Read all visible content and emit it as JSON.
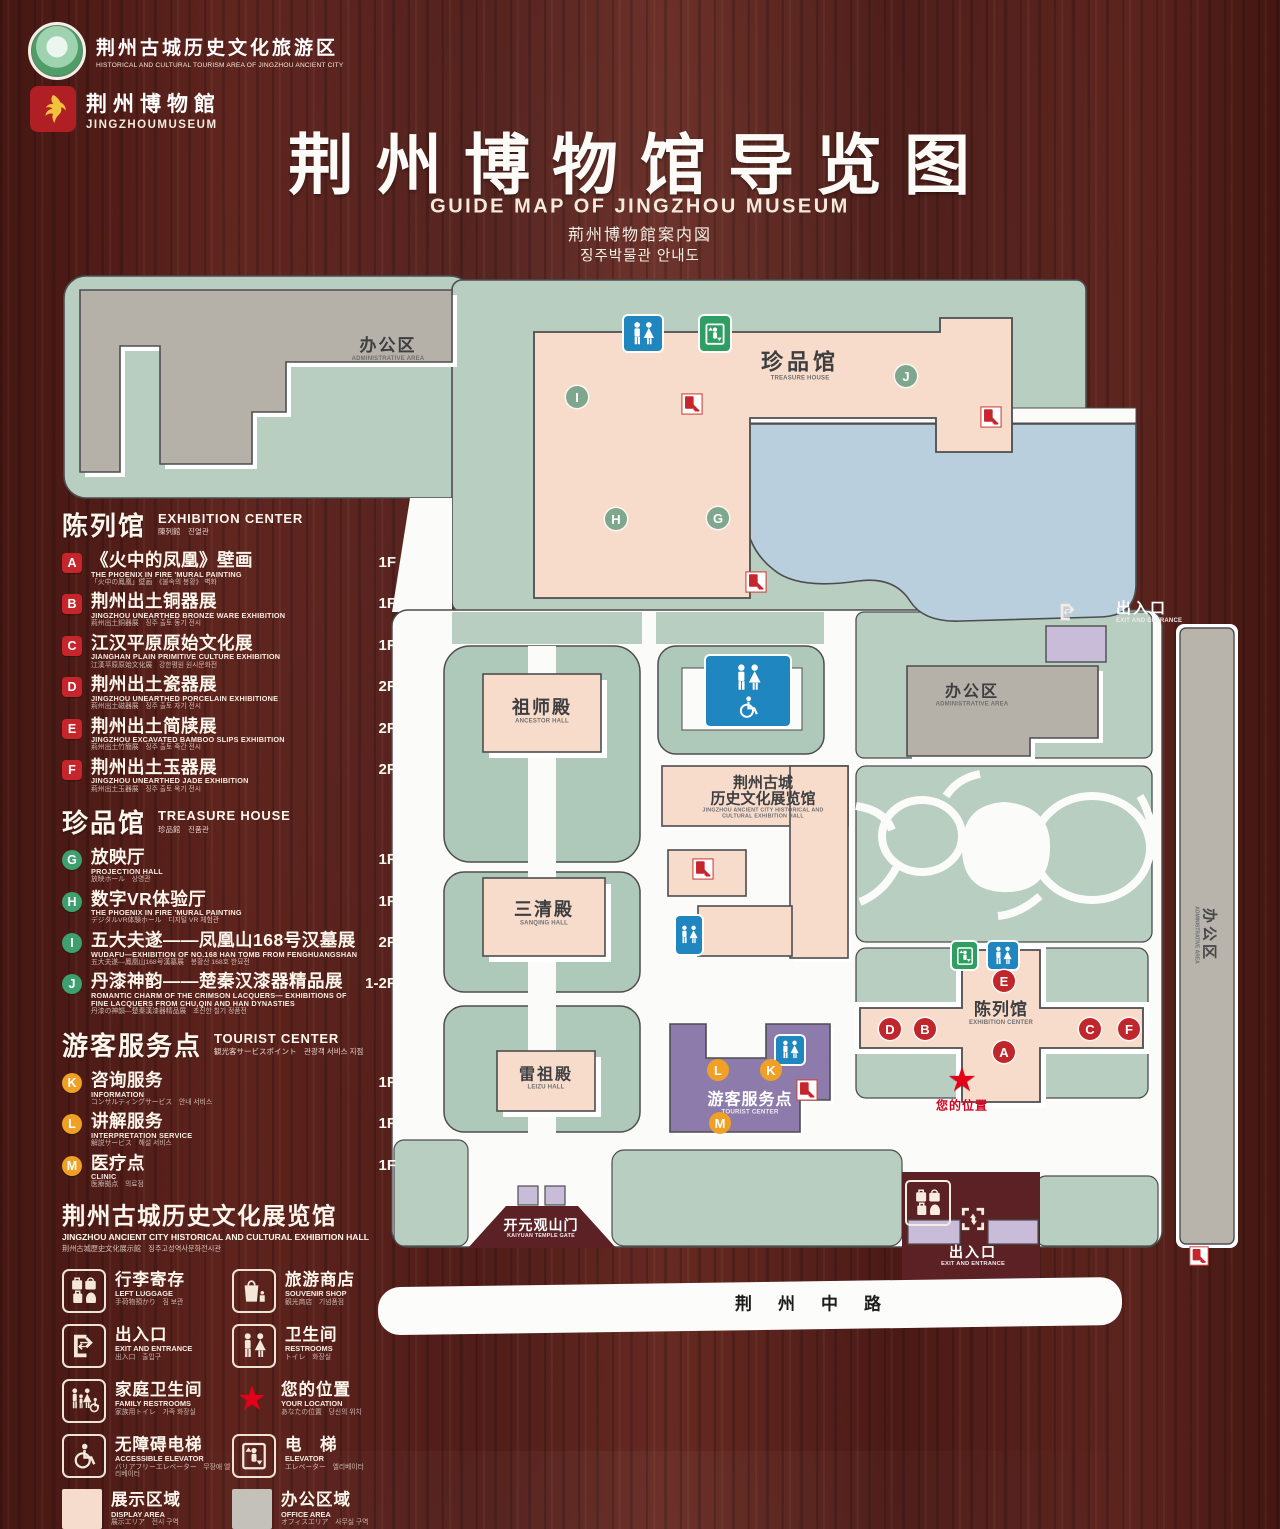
{
  "colors": {
    "wood": "#511d19",
    "map_green": "#b7cec1",
    "building_pink": "#f7dccc",
    "lake_blue": "#b9cfdd",
    "office_gray": "#b6b1a8",
    "tourist_purple": "#8d7cab",
    "gate_lavender": "#c9bcd8",
    "sign_blue": "#1f86c0",
    "sign_green": "#2f9e62",
    "marker_red": "#c0272d",
    "marker_green": "#7fa78e",
    "marker_orange": "#f0a125",
    "star_red": "#e30019",
    "display_swatch": "#f5dccd",
    "office_swatch": "#c3c1b9"
  },
  "header": {
    "logo1": {
      "zh": "荆州古城历史文化旅游区",
      "en": "HISTORICAL AND CULTURAL TOURISM AREA OF JINGZHOU ANCIENT CITY"
    },
    "logo2": {
      "zh": "荆州博物館",
      "en": "JINGZHOUMUSEUM"
    },
    "title_zh": "荆州博物馆导览图",
    "title_en": "GUIDE MAP OF JINGZHOU MUSEUM",
    "title_ja": "荊州博物館案内図",
    "title_ko": "징주박물관 안내도"
  },
  "legend": {
    "sections": [
      {
        "id": "exhibition-center",
        "zh": "陈列馆",
        "en": "EXHIBITION CENTER",
        "sub": "陳列館　진열관",
        "badge": "red",
        "items": [
          {
            "key": "A",
            "zh": "《火中的凤凰》壁画",
            "en": "THE PHOENIX IN FIRE 'MURAL PAINTING",
            "sub": "「火中の鳳凰」壁画　《불속의 봉황》 벽화",
            "floor": "1F"
          },
          {
            "key": "B",
            "zh": "荆州出土铜器展",
            "en": "JINGZHOU UNEARTHED BRONZE WARE EXHIBITION",
            "sub": "荊州出土銅器展　징주 출토 동기 전시",
            "floor": "1F"
          },
          {
            "key": "C",
            "zh": "江汉平原原始文化展",
            "en": "JIANGHAN PLAIN PRIMITIVE CULTURE EXHIBITION",
            "sub": "江漢平原原始文化展　강한평원 원시문화전",
            "floor": "1F"
          },
          {
            "key": "D",
            "zh": "荆州出土瓷器展",
            "en": "JINGZHOU UNEARTHED PORCELAIN EXHIBITIONE",
            "sub": "荊州出土磁器展　징주 출토 자기 전시",
            "floor": "2F"
          },
          {
            "key": "E",
            "zh": "荆州出土简牍展",
            "en": "JINGZHOU EXCAVATED BAMBOO SLIPS EXHIBITION",
            "sub": "荊州出土竹簡展　징주 출토 죽간 전시",
            "floor": "2F"
          },
          {
            "key": "F",
            "zh": "荆州出土玉器展",
            "en": "JINGZHOU UNEARTHED JADE EXHIBITION",
            "sub": "荊州出土玉器展　징주 출토 옥기 전시",
            "floor": "2F"
          }
        ]
      },
      {
        "id": "treasure-house",
        "zh": "珍品馆",
        "en": "TREASURE HOUSE",
        "sub": "珍品館　진품관",
        "badge": "green",
        "items": [
          {
            "key": "G",
            "zh": "放映厅",
            "en": "PROJECTION HALL",
            "sub": "放映ホール　상영관",
            "floor": "1F"
          },
          {
            "key": "H",
            "zh": "数字VR体验厅",
            "en": "THE PHOENIX IN FIRE 'MURAL PAINTING",
            "sub": "デジタルVR体験ホール　디지털 VR 체험관",
            "floor": "1F"
          },
          {
            "key": "I",
            "zh": "五大夫遂——凤凰山168号汉墓展",
            "en": "WUDAFU—EXHIBITION OF NO.168 HAN TOMB FROM FENGHUANGSHAN",
            "sub": "五大夫遂—鳳凰山168号漢墓展　봉황산 168호 한묘전",
            "floor": "2F"
          },
          {
            "key": "J",
            "zh": "丹漆神韵——楚秦汉漆器精品展",
            "en": "ROMANTIC CHARM OF THE CRIMSON LACQUERS— EXHIBITIONS OF FINE LACQUERS FROM CHU,QIN AND HAN DYNASTIES",
            "sub": "丹漆の神韻—楚秦漢漆器精品展　초진한 칠기 정품전",
            "floor": "1-2F"
          }
        ]
      },
      {
        "id": "tourist-center",
        "zh": "游客服务点",
        "en": "TOURIST CENTER",
        "sub": "観光客サービスポイント　관광객 서비스 지점",
        "badge": "orange",
        "items": [
          {
            "key": "K",
            "zh": "咨询服务",
            "en": "INFORMATION",
            "sub": "コンサルティングサービス　안내 서비스",
            "floor": "1F"
          },
          {
            "key": "L",
            "zh": "讲解服务",
            "en": "INTERPRETATION SERVICE",
            "sub": "解説サービス　해설 서비스",
            "floor": "1F"
          },
          {
            "key": "M",
            "zh": "医疗点",
            "en": "CLINIC",
            "sub": "医療拠点　의료점",
            "floor": "1F"
          }
        ]
      }
    ],
    "hall_title": {
      "zh": "荆州古城历史文化展览馆",
      "en": "JINGZHOU ANCIENT CITY HISTORICAL AND CULTURAL EXHIBITION HALL",
      "sub": "荆州古城歴史文化展示館　징주고성역사문화전시관"
    },
    "facilities": [
      {
        "id": "left-luggage",
        "icon": "left-luggage-icon",
        "zh": "行李寄存",
        "en": "LEFT LUGGAGE",
        "sub": "手荷物預かり　짐 보관"
      },
      {
        "id": "souvenir-shop",
        "icon": "souvenir-shop-icon",
        "zh": "旅游商店",
        "en": "SOUVENIR SHOP",
        "sub": "観光商店　기념품점"
      },
      {
        "id": "exit-entrance",
        "icon": "exit-entrance-icon",
        "zh": "出入口",
        "en": "EXIT AND ENTRANCE",
        "sub": "出入口　출입구"
      },
      {
        "id": "restrooms",
        "icon": "restrooms-icon",
        "zh": "卫生间",
        "en": "RESTROOMS",
        "sub": "トイレ　화장실"
      },
      {
        "id": "family-restrooms",
        "icon": "family-restrooms-icon",
        "zh": "家庭卫生间",
        "en": "FAMILY RESTROOMS",
        "sub": "家族用トイレ　가족 화장실"
      },
      {
        "id": "your-location",
        "icon": "your-location-icon",
        "zh": "您的位置",
        "en": "YOUR LOCATION",
        "sub": "あなたの位置　당신의 위치"
      },
      {
        "id": "accessible-elevator",
        "icon": "accessible-elevator-icon",
        "zh": "无障碍电梯",
        "en": "ACCESSIBLE ELEVATOR",
        "sub": "バリアフリーエレベーター　무장애 엘리베이터"
      },
      {
        "id": "elevator",
        "icon": "elevator-icon",
        "zh": "电　梯",
        "en": "ELEVATOR",
        "sub": "エレベーター　엘리베이터"
      },
      {
        "id": "display-area",
        "icon": "display-area-swatch",
        "swatch": "#f5dccd",
        "zh": "展示区域",
        "en": "DISPLAY AREA",
        "sub": "展示エリア　전시 구역"
      },
      {
        "id": "office-area",
        "icon": "office-area-swatch",
        "swatch": "#c3c1b9",
        "zh": "办公区域",
        "en": "OFFICE AREA",
        "sub": "オフィスエリア　사무실 구역"
      }
    ]
  },
  "map": {
    "labels": {
      "admin_top": {
        "zh": "办公区",
        "en": "ADMINISTRATIVE AREA"
      },
      "treasure_house": {
        "zh": "珍品馆",
        "en": "TREASURE HOUSE"
      },
      "ancestor_hall": {
        "zh": "祖师殿",
        "en": "ANCESTOR HALL"
      },
      "sanqing_hall": {
        "zh": "三清殿",
        "en": "SANQING HALL"
      },
      "leizu_hall": {
        "zh": "雷祖殿",
        "en": "LEIZU HALL"
      },
      "history_hall": {
        "zh1": "荆州古城",
        "zh2": "历史文化展览馆",
        "en": "JINGZHOU ANCIENT CITY HISTORICAL AND CULTURAL EXHIBITION HALL"
      },
      "admin_right": {
        "zh": "办公区",
        "en": "ADMINISTRATIVE AREA"
      },
      "admin_strip": {
        "zh": "办公区",
        "en": "ADMINISTRATIVE AREA"
      },
      "tourist_center": {
        "zh": "游客服务点",
        "en": "TOURIST CENTER"
      },
      "exhibition_center": {
        "zh": "陈列馆",
        "en": "EXHIBITION CENTER"
      },
      "kaiyuan_gate": {
        "zh": "开元观山门",
        "en": "KAIYUAN TEMPLE GATE"
      },
      "exit_top": {
        "zh": "出入口",
        "en": "EXIT AND ENTRANCE"
      },
      "exit_bottom": {
        "zh": "出入口",
        "en": "EXIT AND ENTRANCE"
      },
      "your_location": {
        "zh": "您的位置"
      },
      "road": {
        "zh": "荆州中路"
      }
    },
    "markers": [
      {
        "label": "I",
        "style": "green",
        "x": 577,
        "y": 397
      },
      {
        "label": "J",
        "style": "green",
        "x": 906,
        "y": 376
      },
      {
        "label": "H",
        "style": "green",
        "x": 616,
        "y": 519
      },
      {
        "label": "G",
        "style": "green",
        "x": 718,
        "y": 518
      },
      {
        "label": "E",
        "style": "red",
        "x": 1004,
        "y": 981
      },
      {
        "label": "D",
        "style": "red",
        "x": 890,
        "y": 1029
      },
      {
        "label": "B",
        "style": "red",
        "x": 925,
        "y": 1029
      },
      {
        "label": "A",
        "style": "red",
        "x": 1004,
        "y": 1052
      },
      {
        "label": "C",
        "style": "red",
        "x": 1090,
        "y": 1029
      },
      {
        "label": "F",
        "style": "red",
        "x": 1129,
        "y": 1029
      },
      {
        "label": "L",
        "style": "orange",
        "x": 718,
        "y": 1070
      },
      {
        "label": "K",
        "style": "orange",
        "x": 771,
        "y": 1070
      },
      {
        "label": "M",
        "style": "orange",
        "x": 720,
        "y": 1123
      }
    ]
  }
}
